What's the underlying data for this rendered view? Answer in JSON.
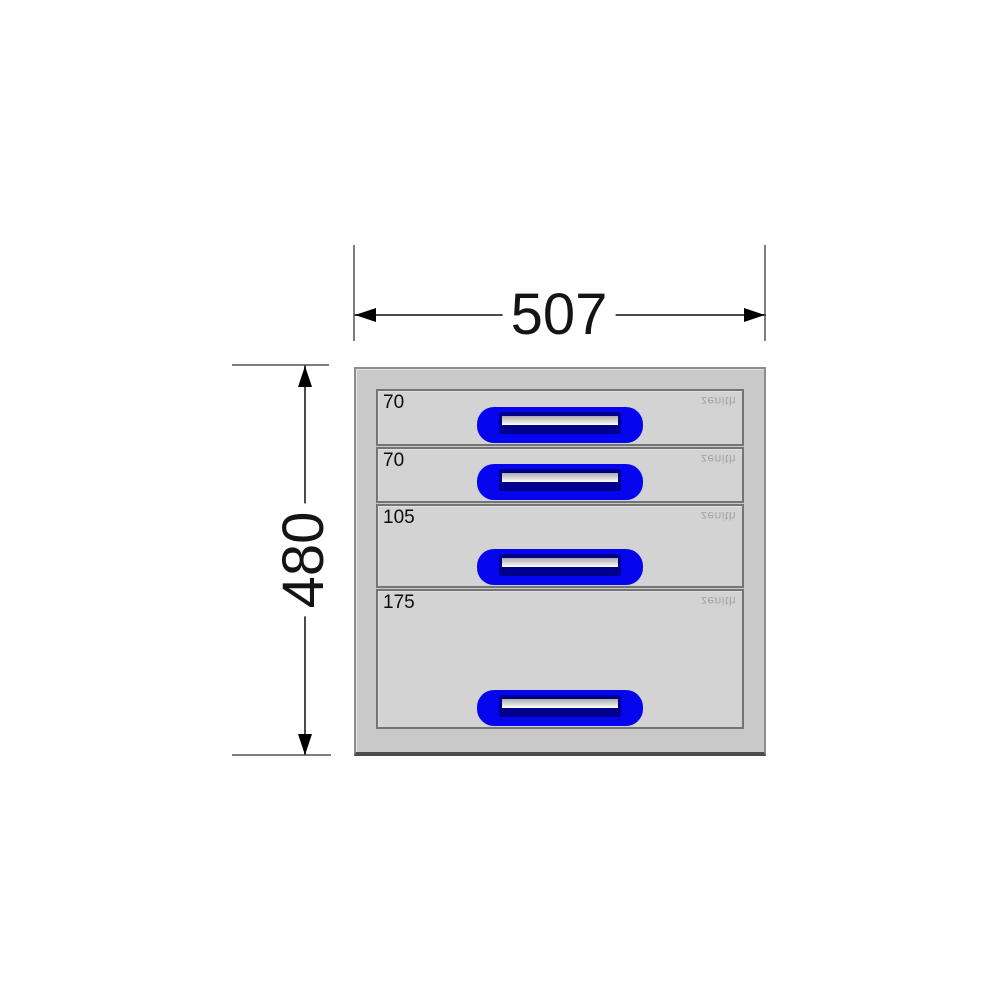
{
  "drawing": {
    "dimensions": {
      "width_label": "507",
      "height_label": "480"
    },
    "cabinet": {
      "brand_text": "zenith",
      "drawers": [
        {
          "height_label": "70"
        },
        {
          "height_label": "70"
        },
        {
          "height_label": "105"
        },
        {
          "height_label": "175"
        }
      ]
    },
    "colors": {
      "cabinet_body": "#c9c9c9",
      "drawer_face": "#d3d3d3",
      "drawer_border": "#747474",
      "handle_blue": "#0505f0",
      "handle_recess_navy": "#00008b",
      "handle_grip_light": "#ffffff",
      "dimension_text": "#141414",
      "dimension_line": "#4a4a4a",
      "extension_line": "#7d7d7d",
      "brand_text_color": "#a3a3a3",
      "background": "#ffffff"
    }
  }
}
